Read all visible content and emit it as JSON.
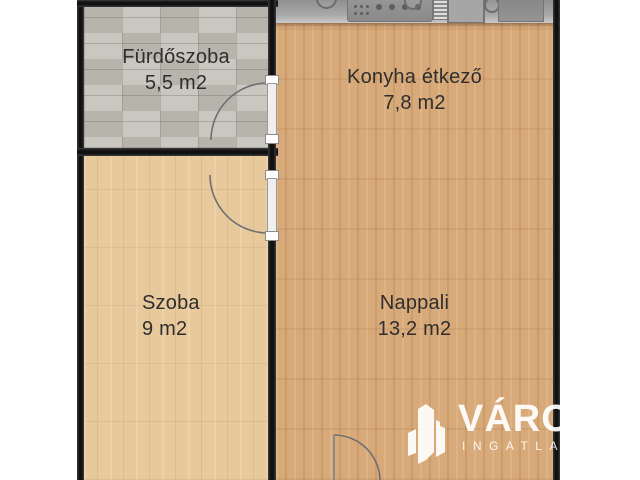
{
  "plan": {
    "kind": "apartment-floor-plan",
    "rooms": {
      "bathroom": {
        "name": "Fürdőszoba",
        "area": "5,5 m2"
      },
      "kitchen": {
        "name": "Konyha étkező",
        "area": "7,8 m2"
      },
      "room": {
        "name": "Szoba",
        "area": "9 m2"
      },
      "living": {
        "name": "Nappali",
        "area": "13,2 m2"
      }
    },
    "icons": [
      "stove-icon",
      "burner-knob-icon",
      "vent-grill-icon",
      "sink-drainer-icon",
      "sink-tap-icon",
      "sink-basin-icon",
      "door-swing-icon"
    ],
    "colors": {
      "wall": "#1a1a1a",
      "tile_floor": "#c2bfb7",
      "wood_light": "#e7c99c",
      "wood_warm": "#d9aa79",
      "counter": "#9a9a9a",
      "label_text": "#2e2e2e",
      "watermark": "#ffffff"
    }
  },
  "watermark": {
    "brand": "VÁROS",
    "subtitle": "INGATLAN"
  }
}
